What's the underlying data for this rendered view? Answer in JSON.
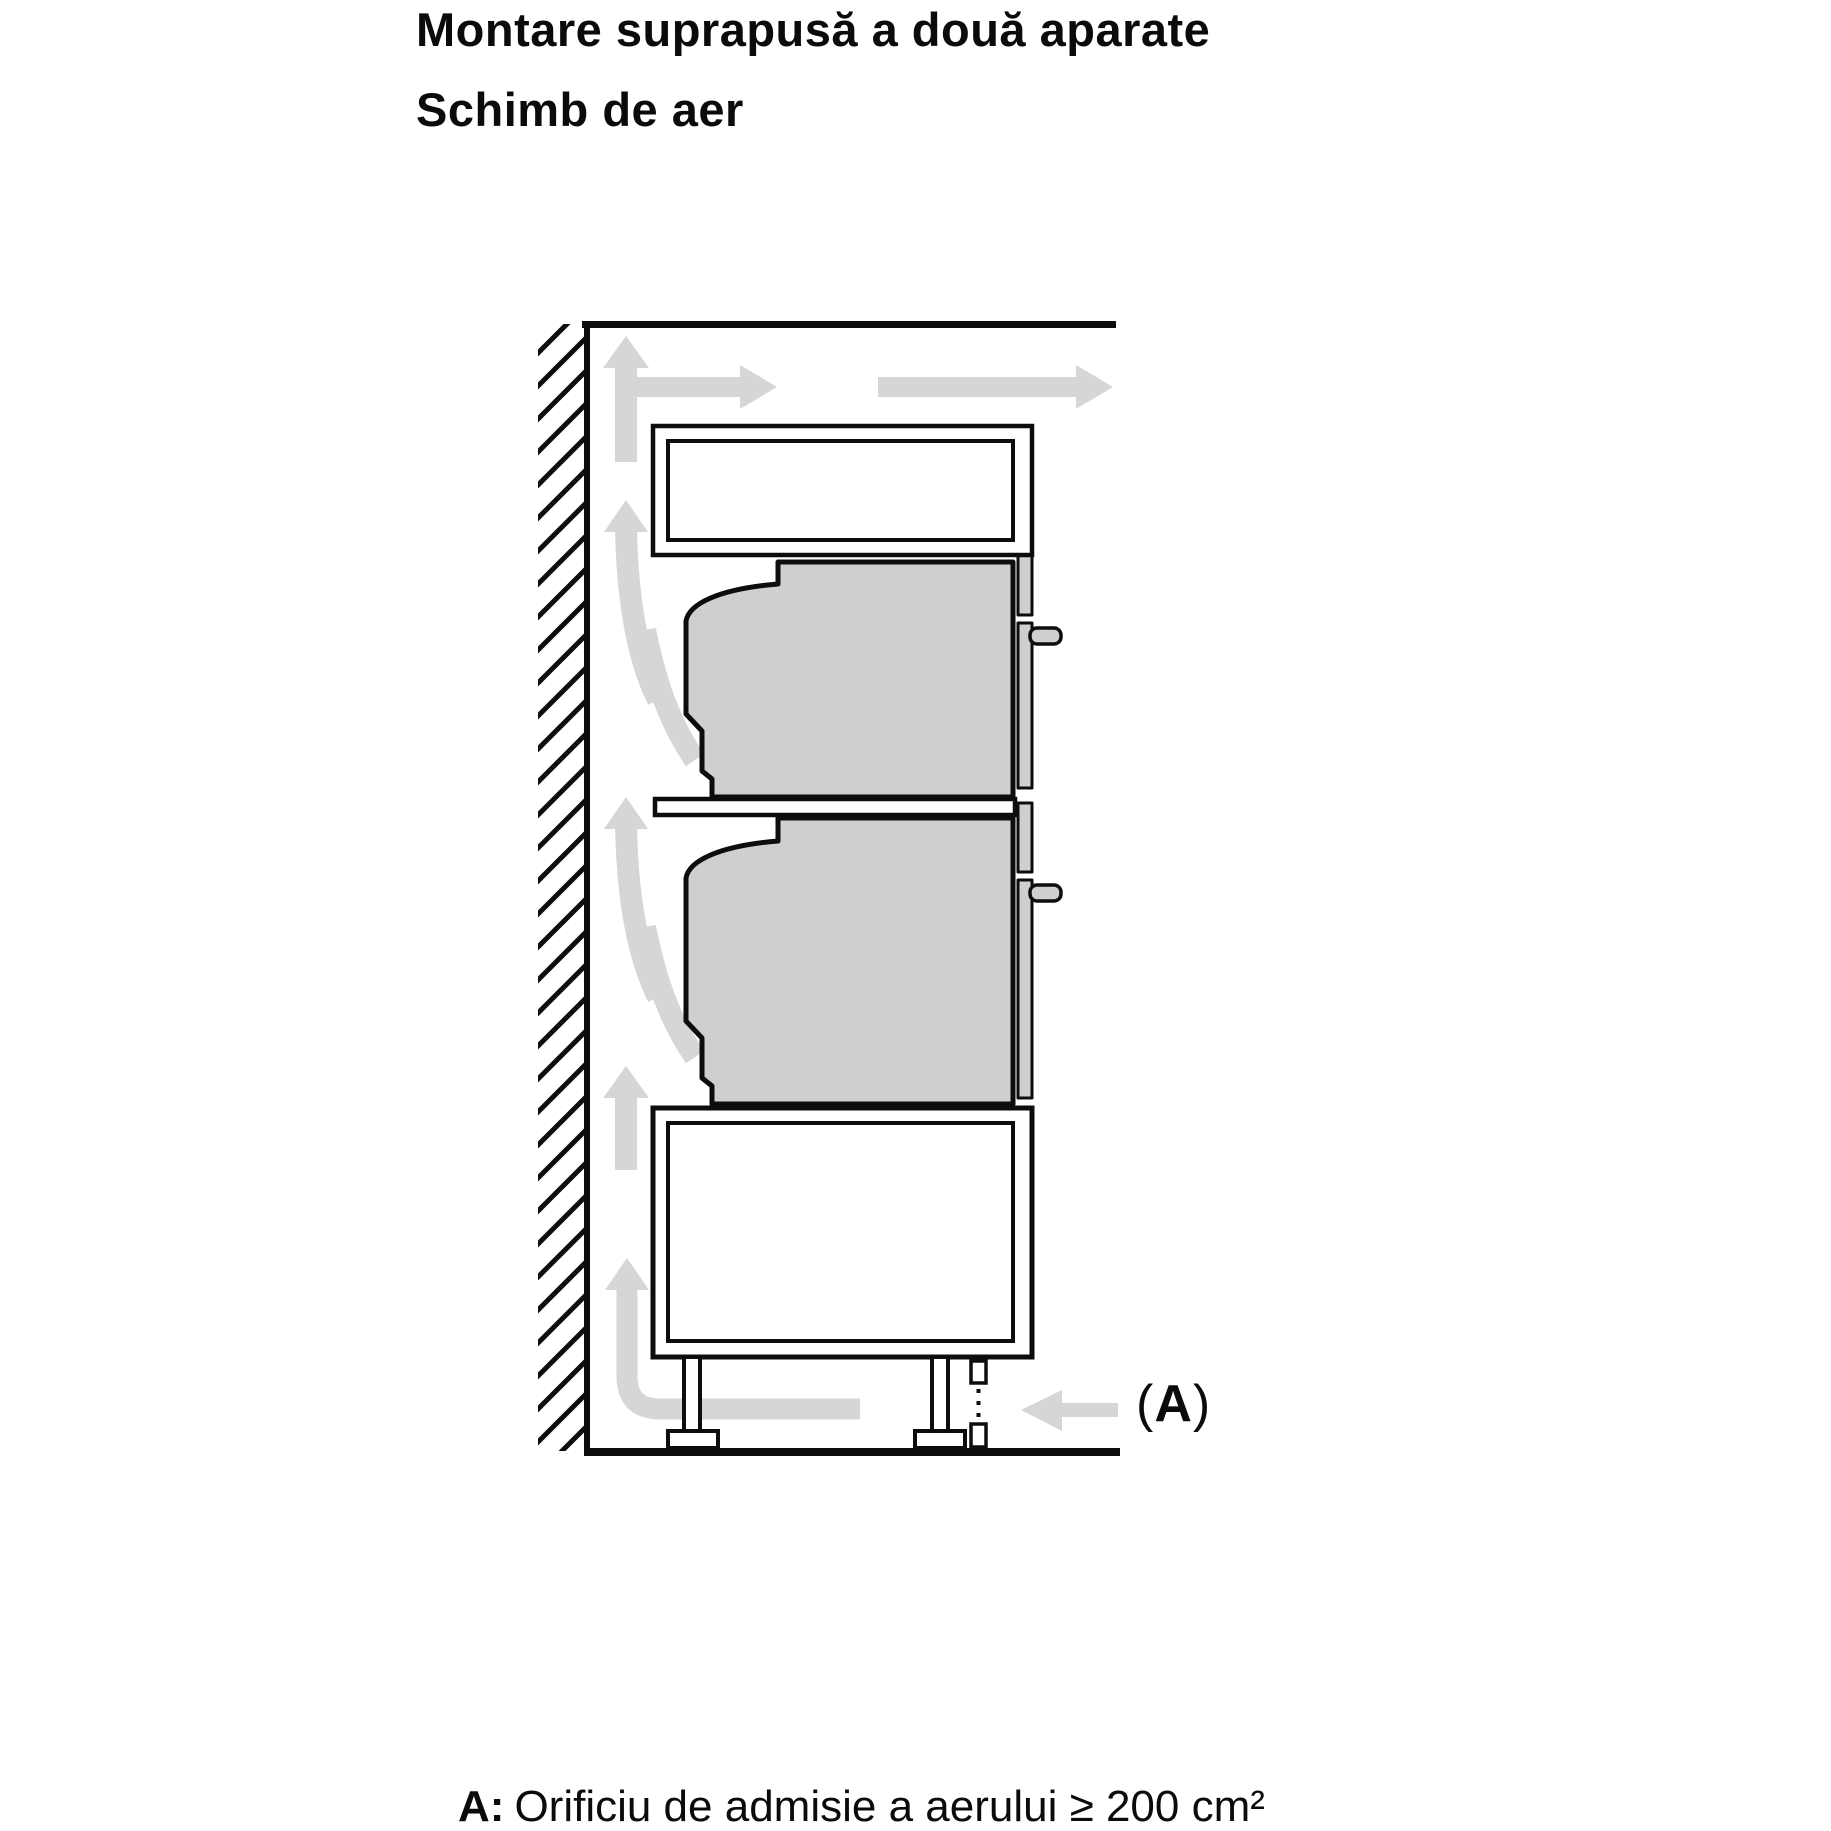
{
  "title": "Montare suprapusă a două aparate",
  "subtitle": "Schimb de aer",
  "diagram": {
    "air_inlet_label": {
      "open": "(",
      "letter": "A",
      "close": ")"
    },
    "colors": {
      "background": "#ffffff",
      "line": "#0d0d0d",
      "airflow": "#d6d6d6",
      "appliance": "#cfcfcf",
      "text": "#0b0b0b"
    }
  },
  "caption": {
    "label": "A:",
    "text": "Orificiu de admisie a aerului ≥ 200 cm²"
  }
}
